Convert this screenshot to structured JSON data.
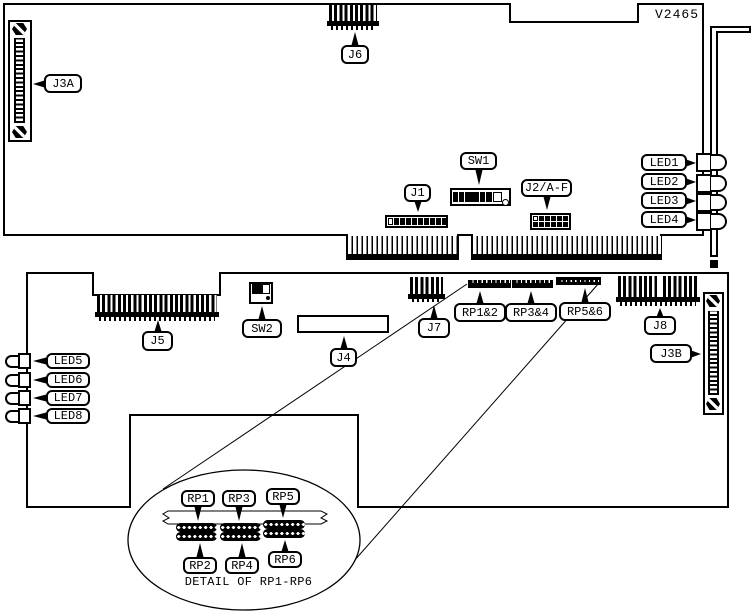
{
  "part_number": "V2465",
  "top_board": {
    "callouts": {
      "j3a": "J3A",
      "j6": "J6",
      "sw1": "SW1",
      "j1": "J1",
      "j2af": "J2/A-F",
      "led1": "LED1",
      "led2": "LED2",
      "led3": "LED3",
      "led4": "LED4"
    }
  },
  "bottom_board": {
    "callouts": {
      "j5": "J5",
      "sw2": "SW2",
      "j4": "J4",
      "j7": "J7",
      "rp12": "RP1&2",
      "rp34": "RP3&4",
      "rp56": "RP5&6",
      "j8": "J8",
      "j3b": "J3B",
      "led5": "LED5",
      "led6": "LED6",
      "led7": "LED7",
      "led8": "LED8"
    }
  },
  "detail": {
    "caption": "DETAIL OF RP1-RP6",
    "callouts": {
      "rp1": "RP1",
      "rp2": "RP2",
      "rp3": "RP3",
      "rp4": "RP4",
      "rp5": "RP5",
      "rp6": "RP6"
    }
  }
}
